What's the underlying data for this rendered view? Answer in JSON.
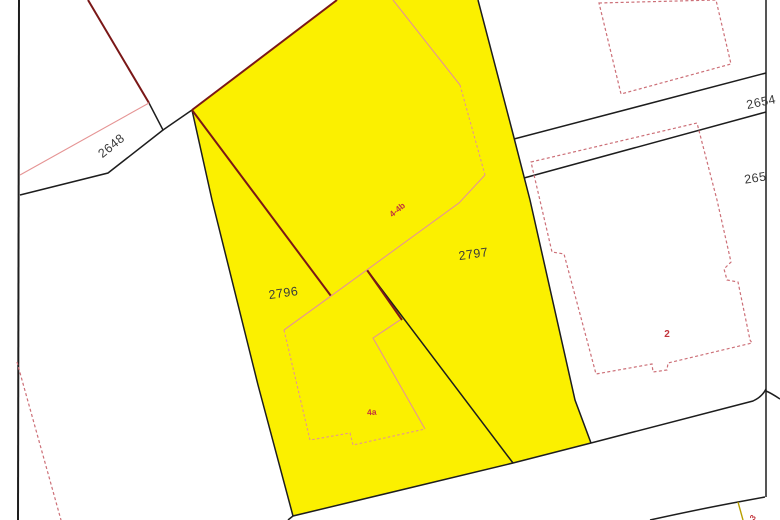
{
  "map": {
    "type": "cadastral-parcel-map",
    "parcels": {
      "p2648": {
        "label": "2648"
      },
      "p2654": {
        "label": "2654"
      },
      "p265x": {
        "label": "265"
      },
      "p2796": {
        "label": "2796",
        "highlighted": true
      },
      "p2797": {
        "label": "2797",
        "highlighted": true
      }
    },
    "buildings": {
      "b44b": {
        "label": "4-4b"
      },
      "b4a": {
        "label": "4a"
      },
      "b2": {
        "label": "2"
      },
      "b3": {
        "label": "3"
      }
    },
    "colors": {
      "background": "#ffffff",
      "highlight_yellow": "#fbf000",
      "boundary_black": "#1d1d1d",
      "boundary_maroon": "#7a1717",
      "edge_pink": "#e59494",
      "building_red": "#cc6f77",
      "label_dark": "#3a3a3a",
      "label_red": "#c2343c",
      "utility_olive": "#b8a000"
    }
  }
}
